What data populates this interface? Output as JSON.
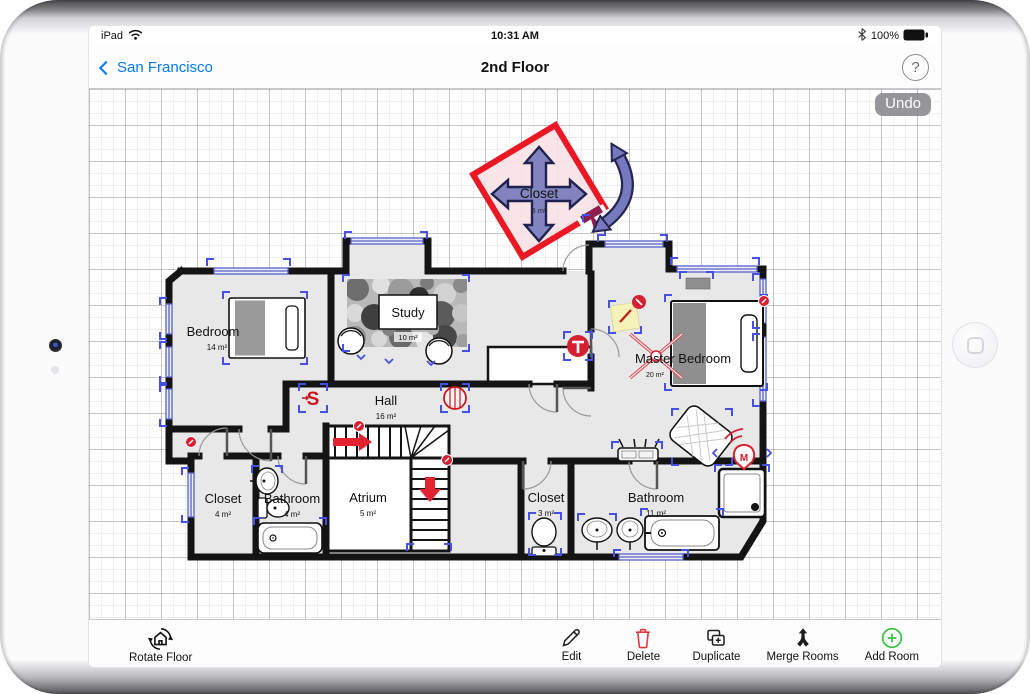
{
  "status_bar": {
    "carrier": "iPad",
    "time": "10:31 AM",
    "battery": "100%"
  },
  "nav_bar": {
    "back_label": "San Francisco",
    "title": "2nd Floor",
    "help_label": "?"
  },
  "canvas": {
    "undo_label": "Undo"
  },
  "floor_plan": {
    "selected_room": {
      "name": "Closet",
      "area": "5 m²"
    },
    "rooms": {
      "bedroom": {
        "name": "Bedroom",
        "area": "14 m²"
      },
      "study": {
        "name": "Study",
        "area": "10 m²"
      },
      "hall": {
        "name": "Hall",
        "area": "16 m²"
      },
      "master_bedroom": {
        "name": "Master Bedroom",
        "area": "20 m²"
      },
      "closet_left": {
        "name": "Closet",
        "area": "4 m²"
      },
      "bathroom_left": {
        "name": "Bathroom",
        "area": "4 m²"
      },
      "atrium": {
        "name": "Atrium",
        "area": "5 m²"
      },
      "closet_right": {
        "name": "Closet",
        "area": "3 m²"
      },
      "bathroom_right": {
        "name": "Bathroom",
        "area": "11 m²"
      }
    },
    "markers": {
      "smoke_detector": "S",
      "thermostat": "T",
      "motion_sensor": "M"
    },
    "colors": {
      "selection_border": "#ea1822",
      "selection_fill": "#f8e1e6",
      "handle": "#7076b8",
      "bracket_blue": "#4450e6",
      "marker_red": "#d42030"
    }
  },
  "toolbar": {
    "rotate_floor": "Rotate Floor",
    "edit": "Edit",
    "delete": "Delete",
    "duplicate": "Duplicate",
    "merge_rooms": "Merge Rooms",
    "add_room": "Add Room",
    "delete_color": "#e0393f",
    "add_color": "#35c53f"
  }
}
